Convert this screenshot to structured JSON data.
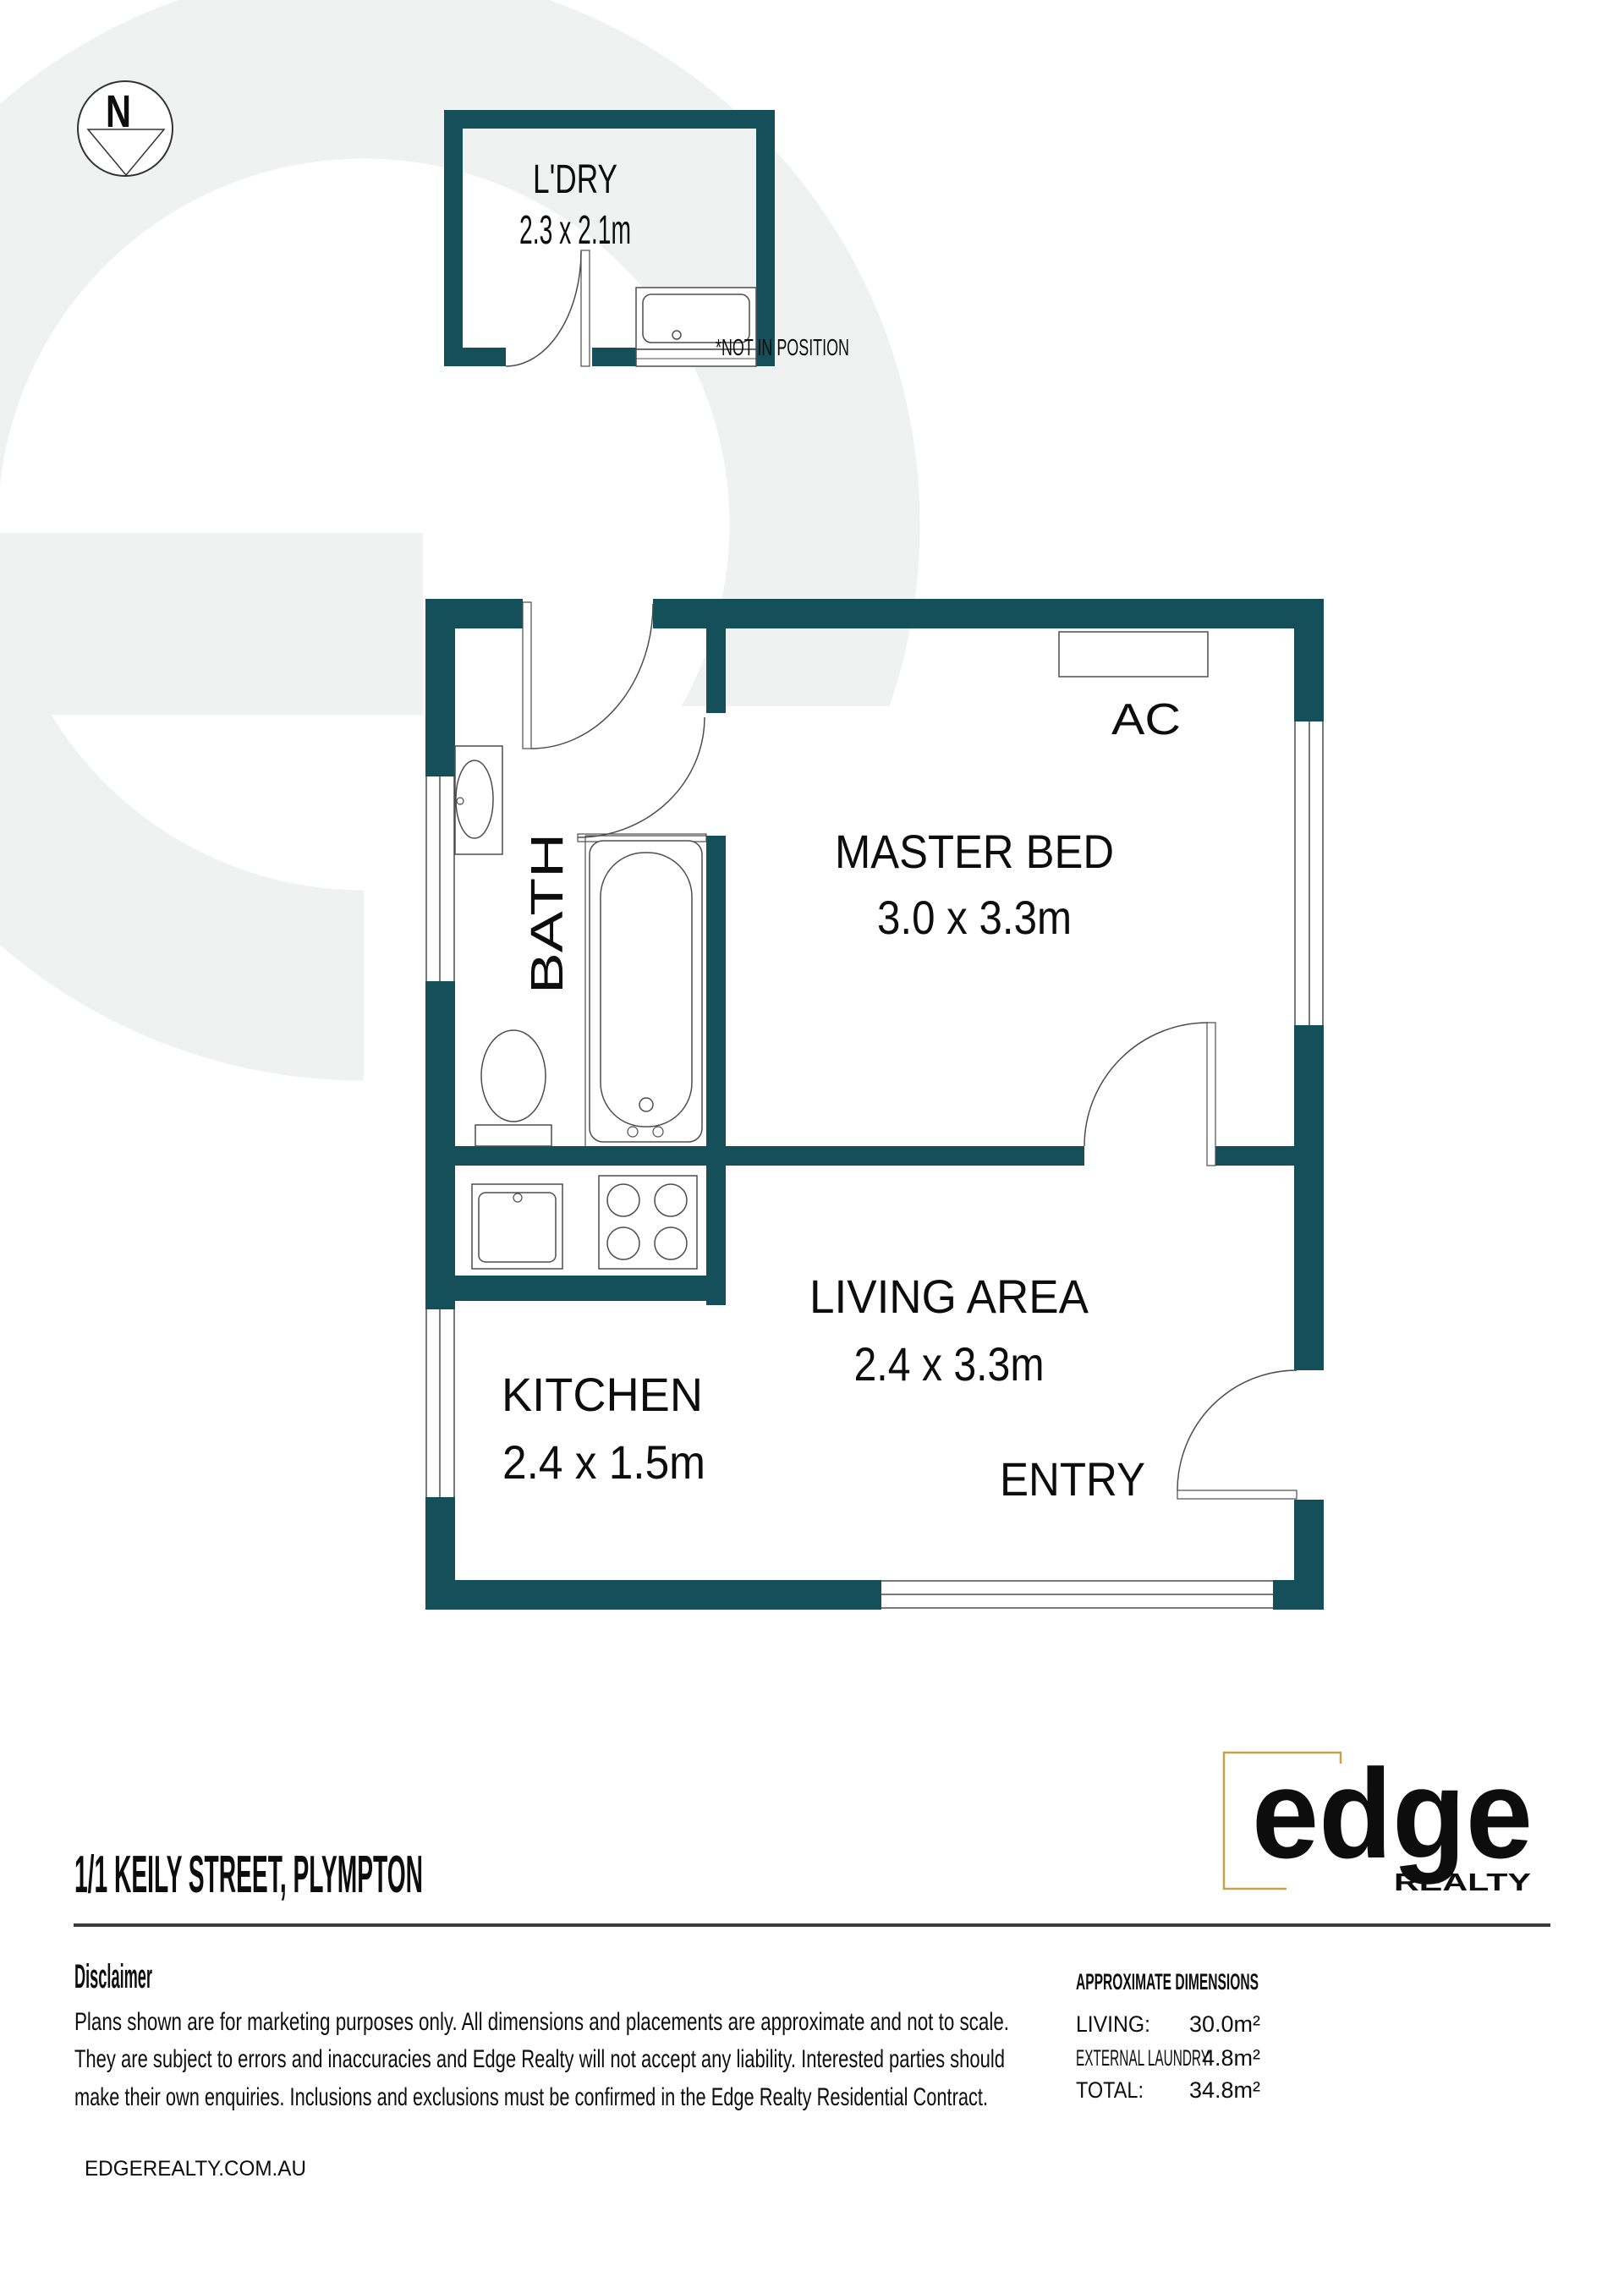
{
  "colors": {
    "wall": "#15505a",
    "outline": "#4d4d4d",
    "text": "#0d0d0d",
    "muted_text": "#5c5c5c",
    "watermark": "#f0f1f1",
    "logo_gold": "#c5a14b",
    "logo_teal": "#16505c",
    "rule": "#3b3b3b"
  },
  "compass": {
    "north_label": "N"
  },
  "laundry": {
    "name": "L'DRY",
    "dims": "2.3 x 2.1m",
    "note": "*NOT IN POSITION"
  },
  "plan": {
    "bath_name": "BATH",
    "master_name": "MASTER BED",
    "master_dims": "3.0 x 3.3m",
    "ac_label": "AC",
    "living_name": "LIVING AREA",
    "living_dims": "2.4 x 3.3m",
    "kitchen_name": "KITCHEN",
    "kitchen_dims": "2.4 x 1.5m",
    "entry_label": "ENTRY"
  },
  "footer": {
    "address": "1/1 KEILY STREET, PLYMPTON",
    "disclaimer_heading": "Disclaimer",
    "disclaimer_lines": [
      "Plans shown are for marketing purposes only. All dimensions and placements are approximate and not to scale.",
      "They are subject to errors and inaccuracies and Edge Realty will not accept any liability. Interested parties should",
      "make their own enquiries. Inclusions and exclusions must be confirmed in the Edge Realty Residential Contract."
    ],
    "website": "EDGEREALTY.COM.AU"
  },
  "dimensions": {
    "heading": "APPROXIMATE DIMENSIONS",
    "rows": [
      {
        "label": "LIVING:",
        "value": "30.0m²"
      },
      {
        "label": "EXTERNAL LAUNDRY",
        "value": "4.8m²"
      },
      {
        "label": "TOTAL:",
        "value": "34.8m²"
      }
    ]
  },
  "logo": {
    "wordmark": "edge",
    "tagline": "REALTY"
  }
}
